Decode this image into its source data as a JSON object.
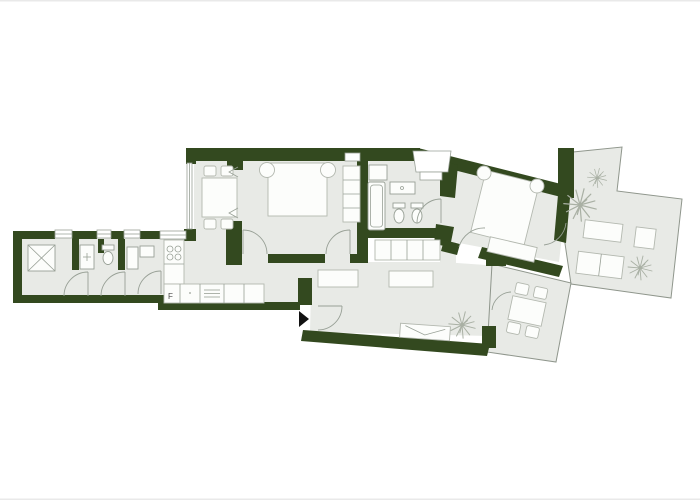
{
  "colors": {
    "background": "#ffffff",
    "wall": "#33491f",
    "floor": "#e8eae6",
    "outline": "#98a096",
    "terrace_outline": "#8f968c",
    "furniture_fill": "#fcfdfb",
    "furniture_stroke": "#b3b8af",
    "plant": "#a9b0a4",
    "arrow": "#111111",
    "label_text": "#4a4a4a",
    "page_edge": "#e9e9e9"
  },
  "labels": {
    "fridge": "F"
  },
  "icons": {
    "entrance_arrow": "right-pointing solid triangle",
    "plant": "radial line burst"
  }
}
